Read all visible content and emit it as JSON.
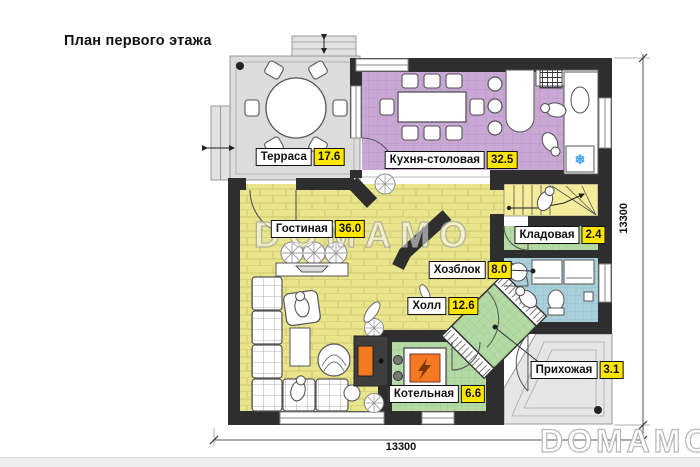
{
  "title": "План первого этажа",
  "rooms": [
    {
      "name": "Терраса",
      "area": "17.6"
    },
    {
      "name": "Кухня-столовая",
      "area": "32.5"
    },
    {
      "name": "Гостиная",
      "area": "36.0"
    },
    {
      "name": "Кладовая",
      "area": "2.4"
    },
    {
      "name": "Хозблок",
      "area": "8.0"
    },
    {
      "name": "Холл",
      "area": "12.6"
    },
    {
      "name": "Прихожая",
      "area": "3.1"
    },
    {
      "name": "Котельная",
      "area": "6.6"
    }
  ],
  "dimensions": {
    "bottom": "13300",
    "right": "13300"
  },
  "watermark": {
    "center": "DOMAMO",
    "corner": "DOMAMO"
  },
  "icons": {
    "freezer": "❄"
  },
  "colors": {
    "wall": "#2e2e2e",
    "kitchen_floor": "#c9a8d5",
    "kitchen_grid": "#bb95c9",
    "living_floor": "#e9e58d",
    "living_grid": "#cdc76c",
    "bath_floor": "#a9cfdb",
    "bath_grid": "#8fbecd",
    "green_floor": "#b5daa6",
    "green_grid": "#9bc98a",
    "stairs_floor": "#f4ec9a",
    "terrace_floor": "#dcdcdc",
    "porch_floor": "#e6e6e6",
    "area_badge": "#ffe600",
    "boiler_orange": "#f47920",
    "freezer_blue": "#3aa0f0"
  }
}
